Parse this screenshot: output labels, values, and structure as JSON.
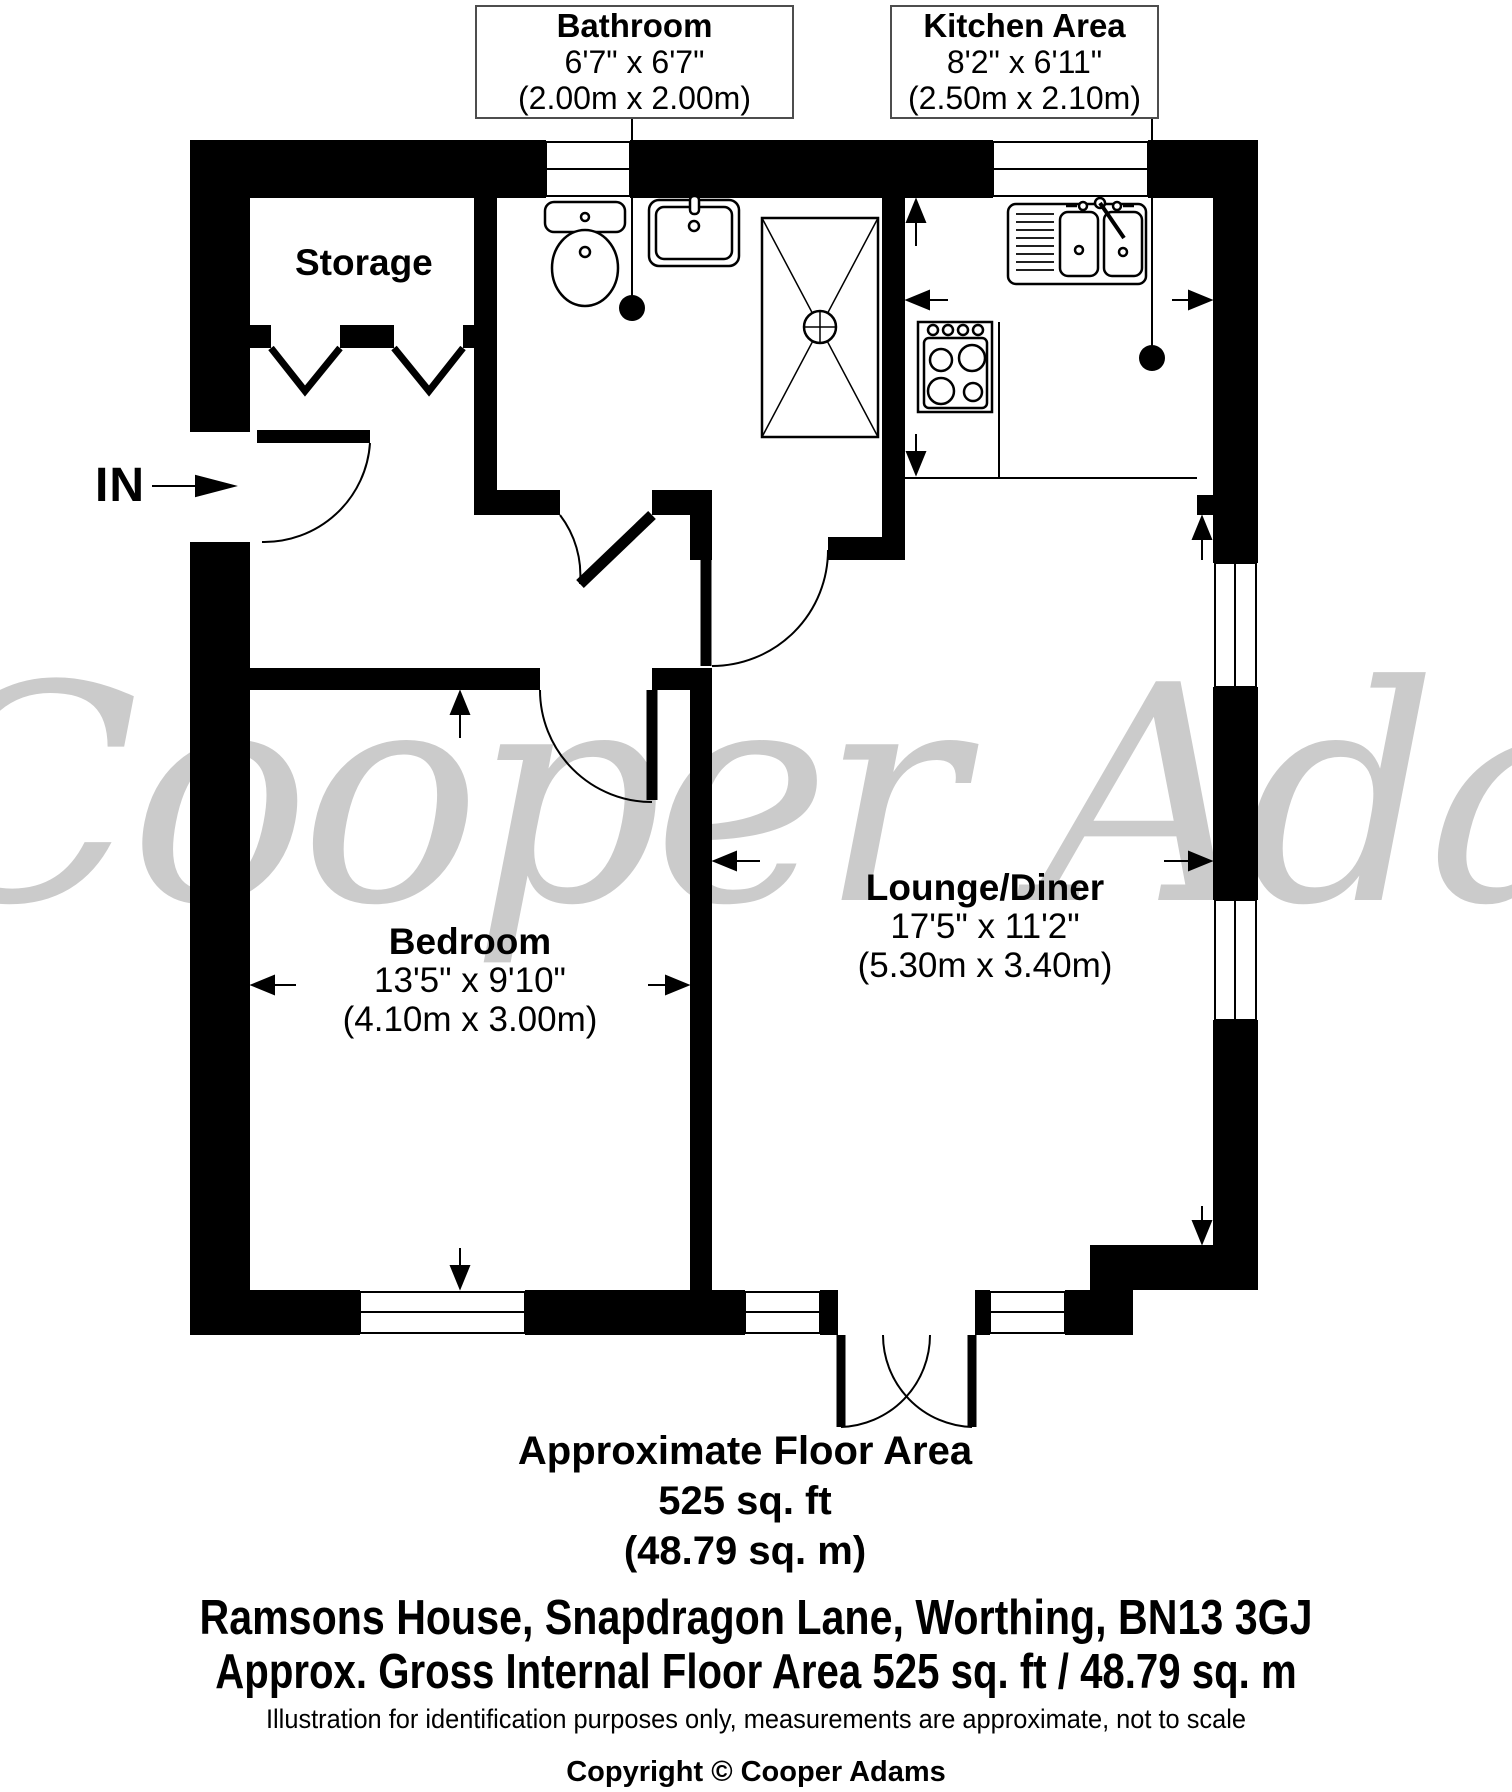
{
  "plan": {
    "rooms": {
      "storage": {
        "label": "Storage"
      },
      "bathroom": {
        "label": "Bathroom",
        "size_imperial": "6'7\" x 6'7\"",
        "size_metric": "(2.00m x 2.00m)"
      },
      "kitchen": {
        "label": "Kitchen Area",
        "size_imperial": "8'2\" x 6'11\"",
        "size_metric": "(2.50m x 2.10m)"
      },
      "bedroom": {
        "label": "Bedroom",
        "size_imperial": "13'5\" x 9'10\"",
        "size_metric": "(4.10m x 3.00m)"
      },
      "lounge": {
        "label": "Lounge/Diner",
        "size_imperial": "17'5\" x 11'2\"",
        "size_metric": "(5.30m x 3.40m)"
      }
    },
    "entrance_label": "IN"
  },
  "watermark": "Cooper Adams",
  "footer": {
    "area_title": "Approximate Floor Area",
    "area_ft": "525 sq. ft",
    "area_m": "(48.79 sq. m)",
    "address": "Ramsons House, Snapdragon Lane, Worthing, BN13 3GJ",
    "gross_area": "Approx. Gross Internal Floor Area 525 sq. ft / 48.79 sq. m",
    "disclaimer": "Illustration for identification purposes only, measurements are approximate, not to scale",
    "copyright": "Copyright © Cooper Adams"
  },
  "colors": {
    "wall": "#000000",
    "watermark": "#cbcbcb",
    "background": "#ffffff",
    "label_border": "#4d4d4d"
  }
}
